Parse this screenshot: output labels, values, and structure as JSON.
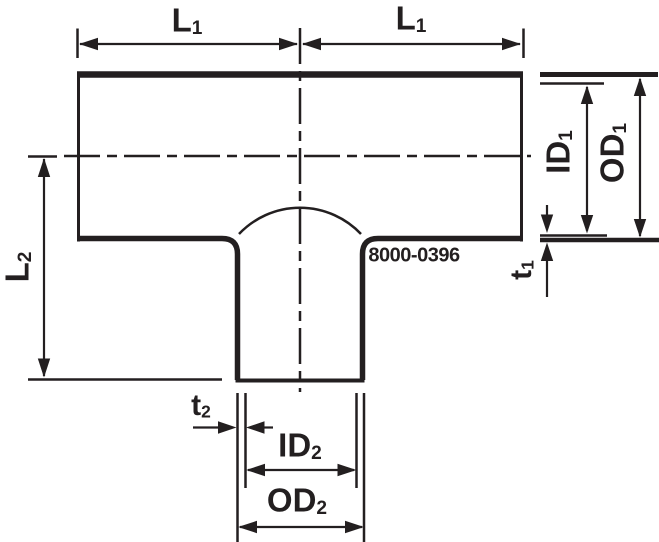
{
  "part_number": "8000-0396",
  "labels": {
    "l1_left": {
      "main": "L",
      "sub": "1"
    },
    "l1_right": {
      "main": "L",
      "sub": "1"
    },
    "l2": {
      "main": "L",
      "sub": "2"
    },
    "id1": {
      "main": "ID",
      "sub": "1"
    },
    "od1": {
      "main": "OD",
      "sub": "1"
    },
    "t1": {
      "main": "t",
      "sub": "1"
    },
    "t2": {
      "main": "t",
      "sub": "2"
    },
    "id2": {
      "main": "ID",
      "sub": "2"
    },
    "od2": {
      "main": "OD",
      "sub": "2"
    }
  },
  "colors": {
    "line": "#231f20",
    "background": "#ffffff"
  }
}
